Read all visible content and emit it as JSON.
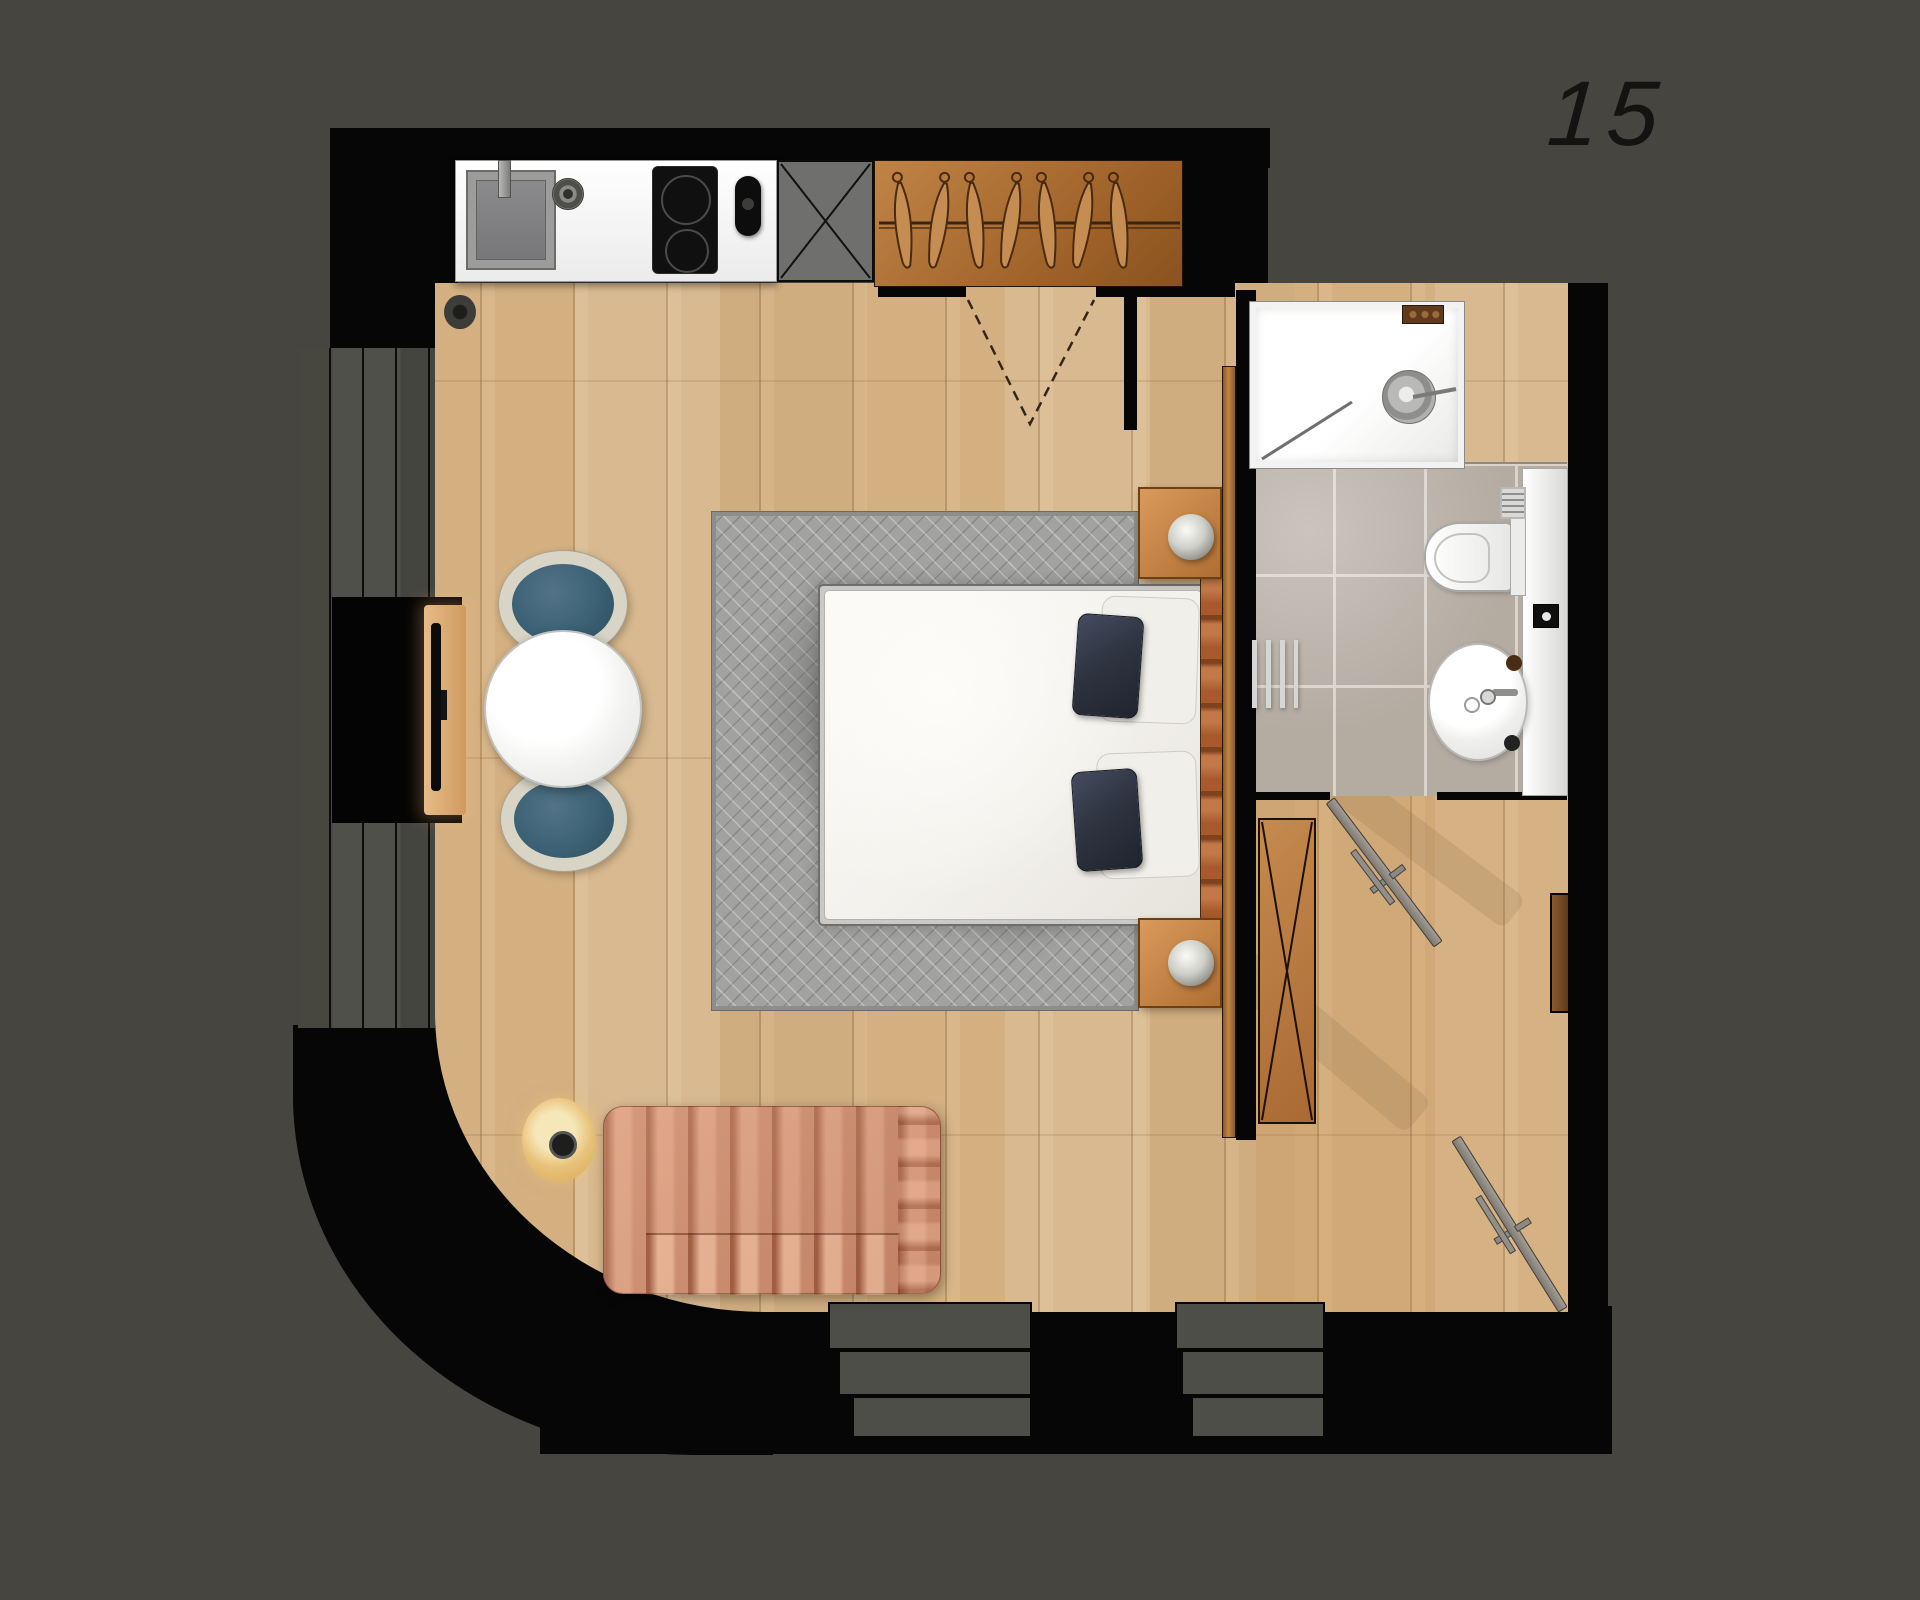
{
  "unit": {
    "number": "15"
  },
  "wardrobe": {
    "hanger_count": 7
  },
  "sofa": {
    "back_channel_count": 8,
    "seat_channel_count": 4
  },
  "palette": {
    "background": "#46453f",
    "wall": "#060606",
    "wood_floor": "#d6b487",
    "hall_floor": "#c79a67",
    "tile_floor": "#b4aba1",
    "rug": "#a2a2a0",
    "kitchen_counter": "#f2f2f2",
    "wardrobe_wood": "#b5793f",
    "sofa": "#c98f72",
    "chair_seat": "#3c6174",
    "chair_back": "#d8d4c6",
    "bed_pillow": "#2e3440",
    "headboard": "#b2663a",
    "lamp_glow": "#e8c27a"
  }
}
